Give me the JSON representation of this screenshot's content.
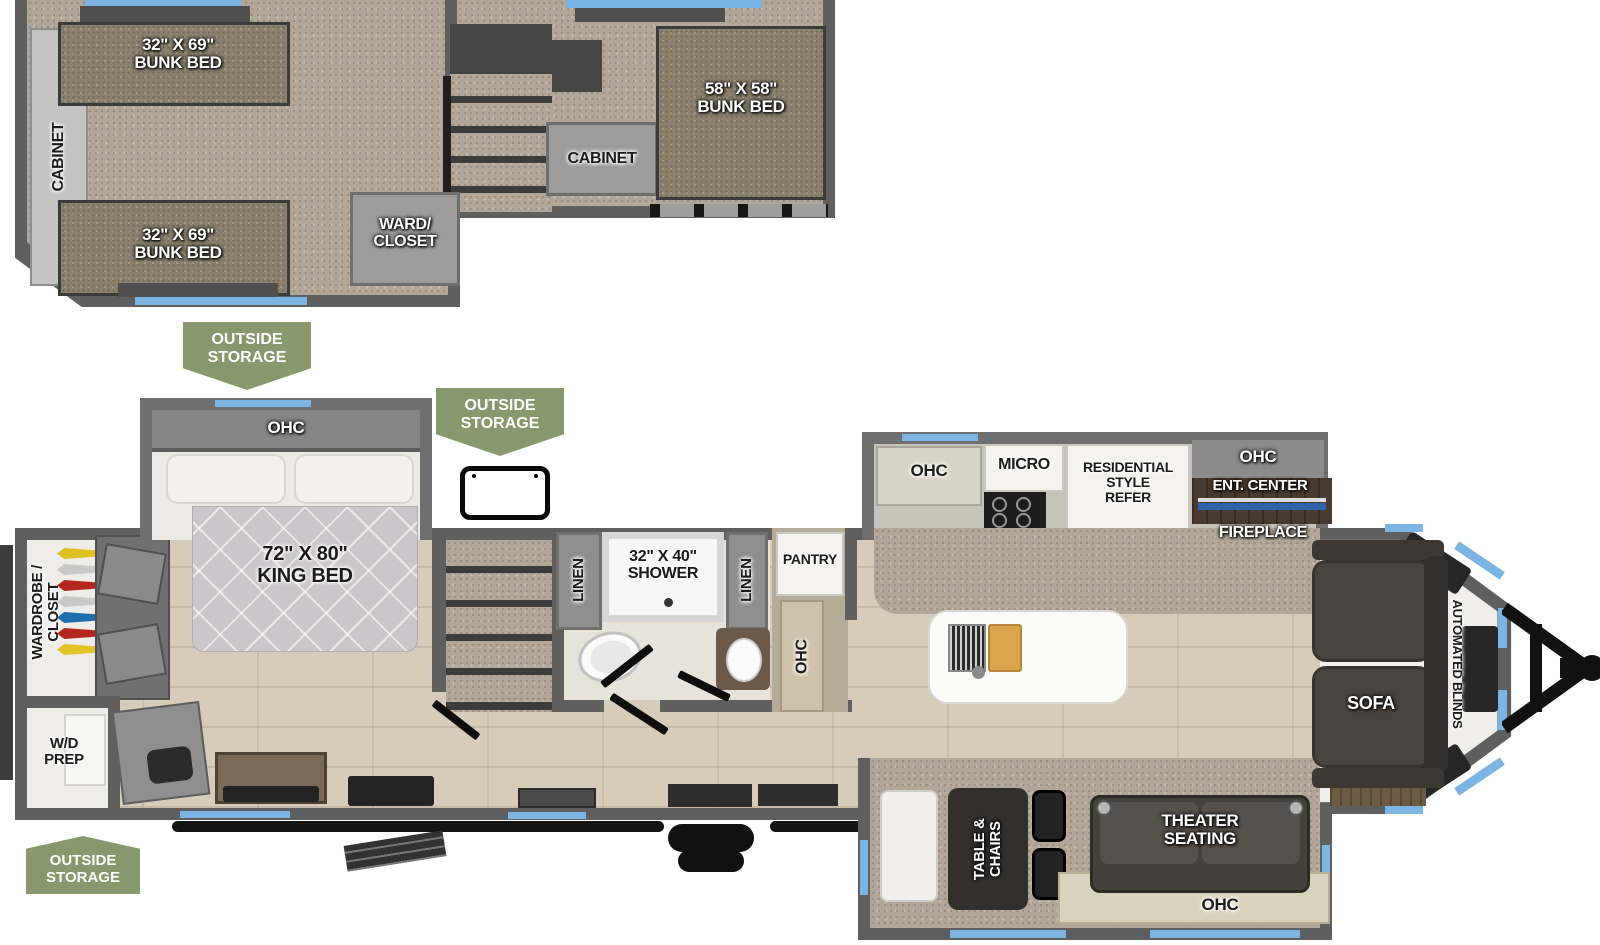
{
  "banners": {
    "storage": "OUTSIDE\nSTORAGE"
  },
  "loft": {
    "side_cabinet": "CABINET",
    "bunk_top": "32\" X 69\"\nBUNK BED",
    "bunk_bottom": "32\" X 69\"\nBUNK BED",
    "bunk_rear": "58\" X 58\"\nBUNK BED",
    "cabinet": "CABINET",
    "ward_closet": "WARD/\nCLOSET"
  },
  "bedroom": {
    "ohc": "OHC",
    "king_bed": "72\" X 80\"\nKING BED",
    "wardrobe_closet": "WARDROBE /\nCLOSET",
    "wd_prep": "W/D\nPREP"
  },
  "bathroom": {
    "linen_left": "LINEN",
    "shower": "32\" X 40\"\nSHOWER",
    "linen_right": "LINEN",
    "pantry": "PANTRY",
    "ohc": "OHC"
  },
  "kitchen": {
    "ohc": "OHC",
    "micro": "MICRO",
    "refer": "RESIDENTIAL\nSTYLE\nREFER"
  },
  "entertainment": {
    "ohc": "OHC",
    "ent_center": "ENT. CENTER",
    "fireplace": "FIREPLACE"
  },
  "living": {
    "sofa": "SOFA",
    "automated_blinds": "AUTOMATED BLINDS"
  },
  "dinette": {
    "table_chairs": "TABLE &\nCHAIRS",
    "theater_seating": "THEATER\nSEATING",
    "ohc": "OHC"
  },
  "colors": {
    "banner_green": "#87996c",
    "wall_gray": "#5f5f5f",
    "window_blue": "#7cb5e3",
    "wood_floor": "#d7ccb9",
    "carpet": "#b2a698",
    "mattress_tan": "#8b816e"
  }
}
